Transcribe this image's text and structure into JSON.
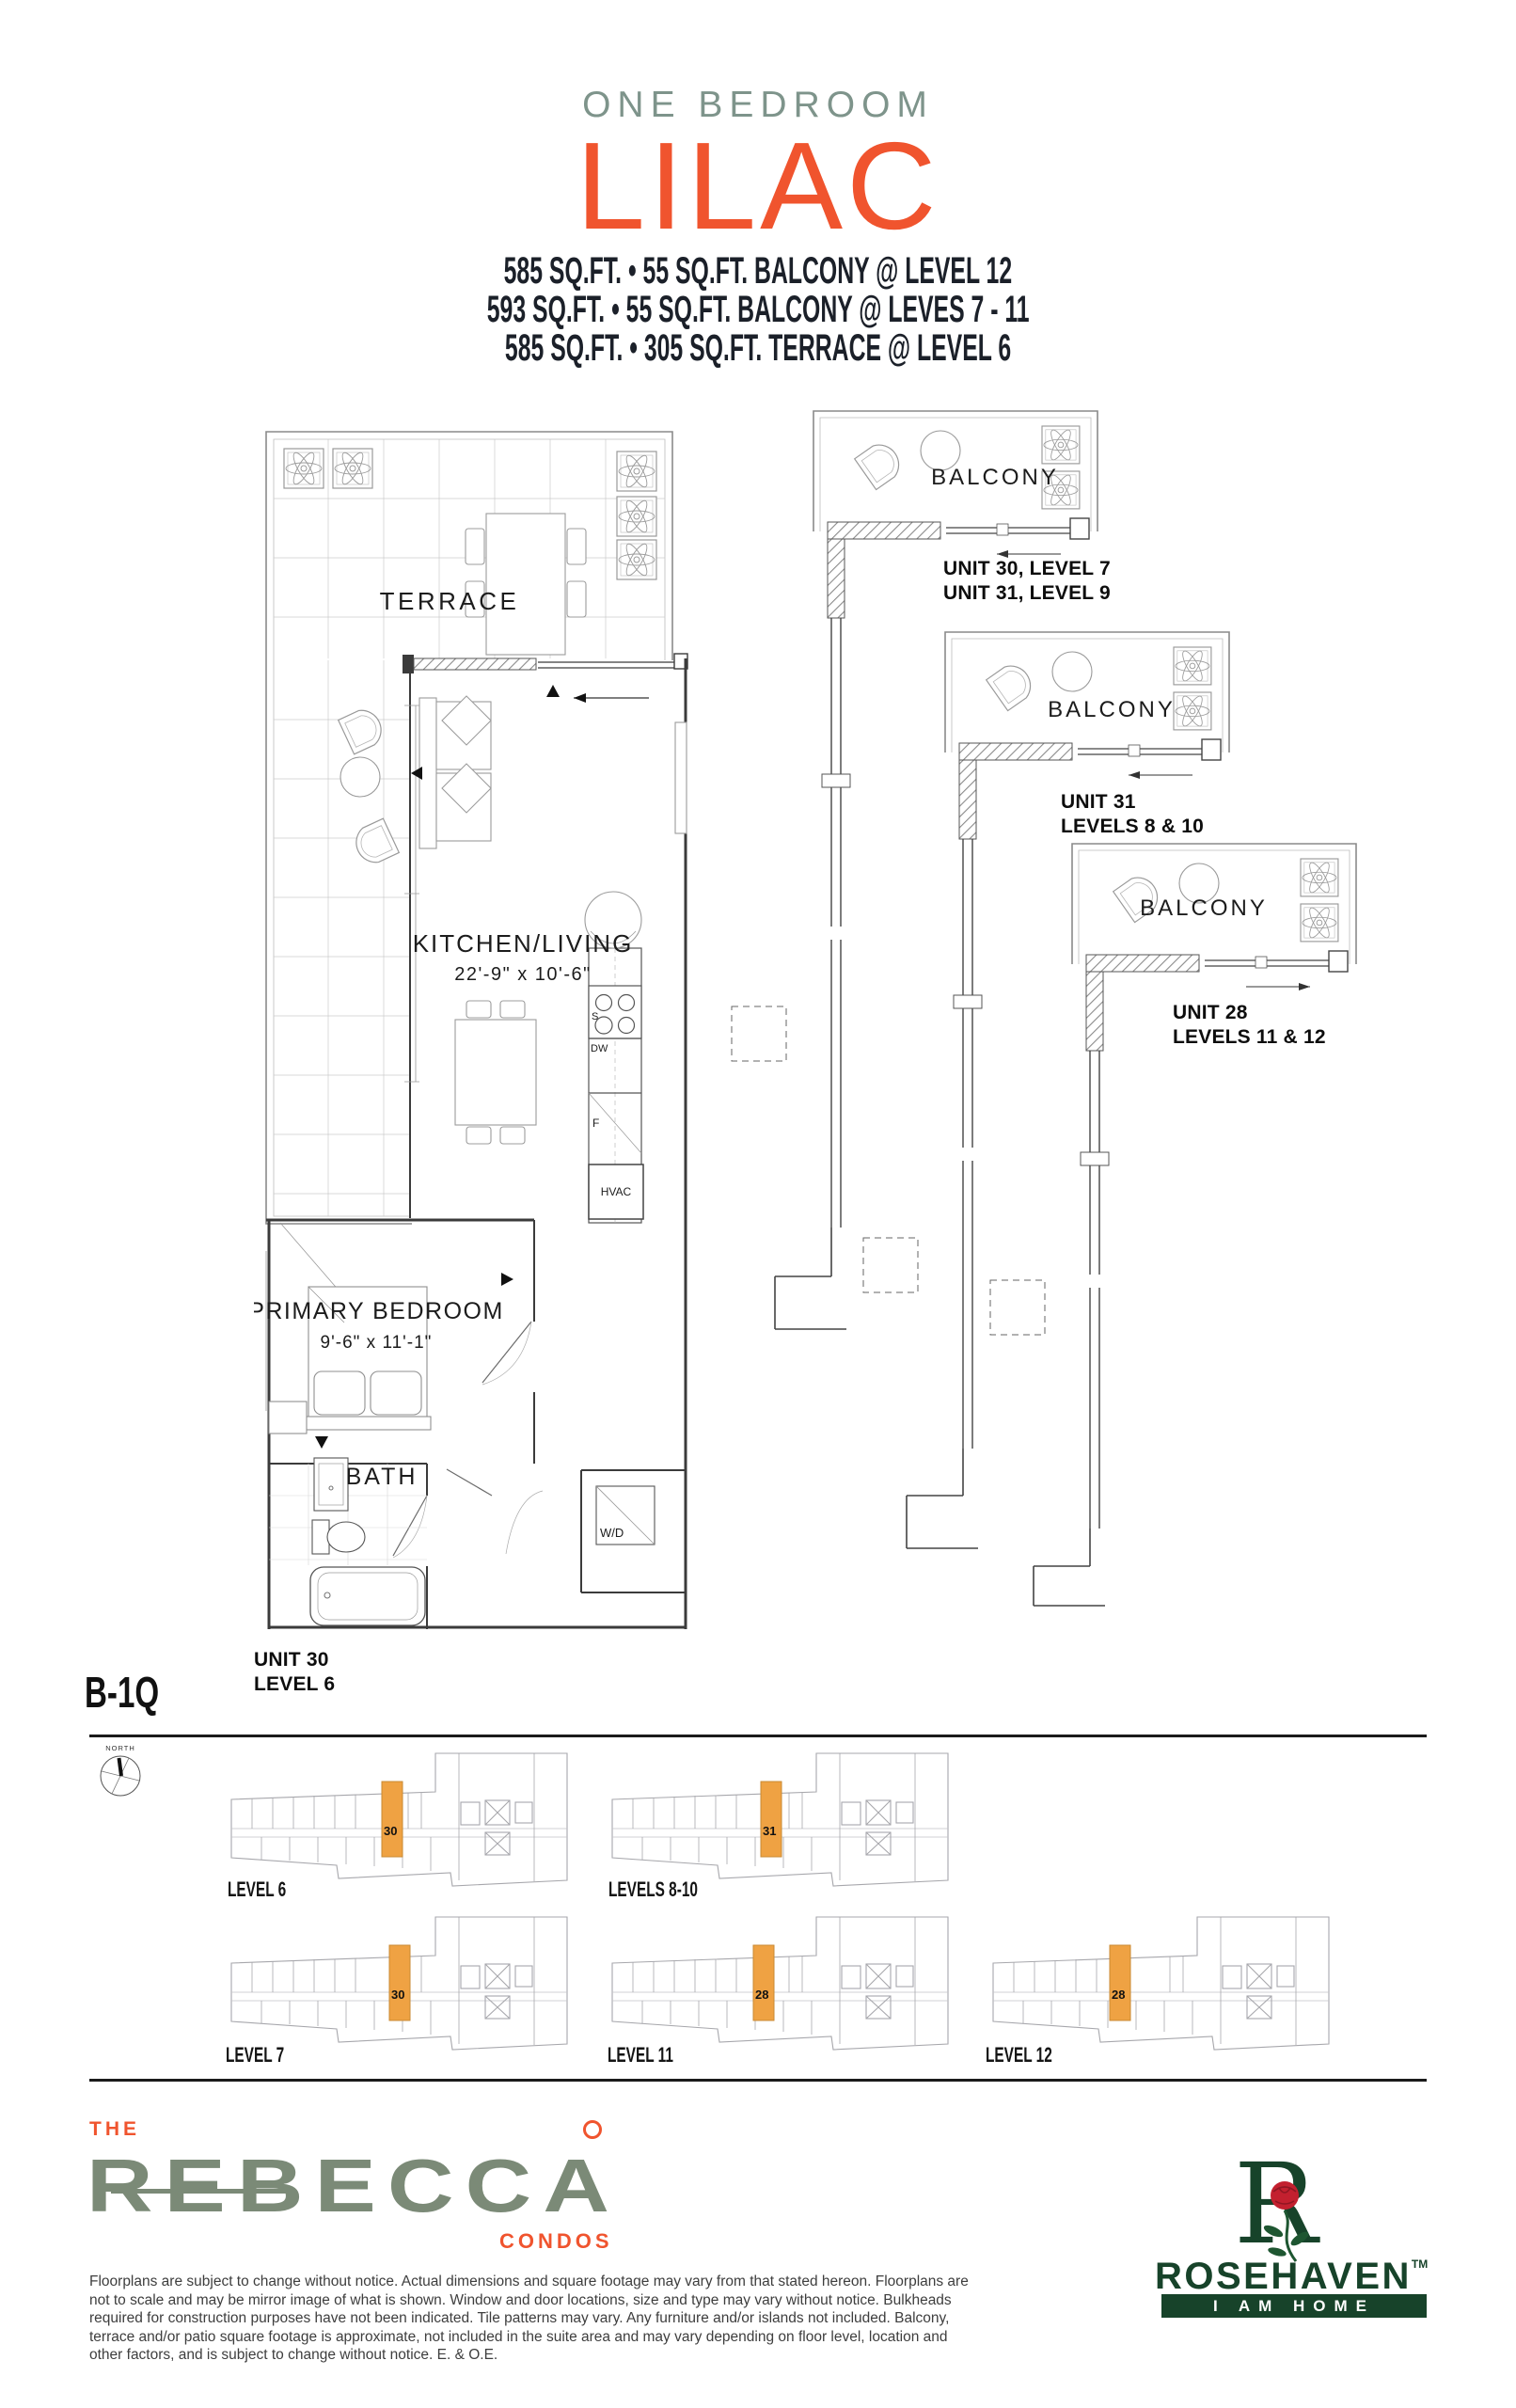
{
  "header": {
    "category": "ONE BEDROOM",
    "plan_name": "LILAC",
    "specs": [
      "585 SQ.FT. • 55 SQ.FT. BALCONY @ LEVEL 12",
      "593 SQ.FT. • 55 SQ.FT. BALCONY @ LEVES 7 - 11",
      "585 SQ.FT. • 305 SQ.FT. TERRACE @ LEVEL 6"
    ]
  },
  "plan": {
    "terrace": "TERRACE",
    "kitchen_living": "KITCHEN/LIVING",
    "kitchen_living_dims": "22'-9\" x 10'-6\"",
    "primary_bedroom": "PRIMARY BEDROOM",
    "primary_bedroom_dims": "9'-6\" x 11'-1\"",
    "bath": "BATH",
    "washer_dryer": "W/D",
    "hvac": "HVAC",
    "fridge": "F",
    "dishwasher": "DW",
    "stove": "S",
    "unit_label_line1": "UNIT 30",
    "unit_label_line2": "LEVEL 6"
  },
  "variants": [
    {
      "balcony": "BALCONY",
      "line1": "UNIT 30, LEVEL 7",
      "line2": "UNIT 31, LEVEL 9"
    },
    {
      "balcony": "BALCONY",
      "line1": "UNIT 31",
      "line2": "LEVELS 8 & 10"
    },
    {
      "balcony": "BALCONY",
      "line1": "UNIT 28",
      "line2": "LEVELS 11 & 12"
    }
  ],
  "plan_code": "B-1Q",
  "compass_label": "NORTH",
  "keyplans": [
    {
      "label": "LEVEL 6",
      "unit": "30"
    },
    {
      "label": "LEVELS 8-10",
      "unit": "31"
    },
    {
      "label": "LEVEL 7",
      "unit": "30"
    },
    {
      "label": "LEVEL 11",
      "unit": "28"
    },
    {
      "label": "LEVEL 12",
      "unit": "28"
    }
  ],
  "footer": {
    "brand_the": "THE",
    "brand_name": "REBECCA",
    "brand_sub": "CONDOS",
    "builder_r": "R",
    "builder_name": "ROSEHAVEN",
    "builder_tm": "TM",
    "builder_tagline": "I AM HOME",
    "disclaimer": "Floorplans are subject to change without notice. Actual dimensions and square footage may vary from that stated hereon. Floorplans are not to scale and may be mirror image of what is shown. Window and door locations, size and type may vary without notice. Bulkheads required for construction purposes have not been indicated. Tile patterns may vary. Any furniture and/or islands not included. Balcony, terrace and/or patio square footage is approximate, not included in the suite area and may vary depending on floor level, location and other factors, and is subject to change without notice. E. & O.E."
  },
  "colors": {
    "accent_orange": "#F0542E",
    "header_sage": "#7E948B",
    "brand_sage": "#7B8A77",
    "rosehaven_green": "#17432A",
    "keyplan_highlight": "#EFA243",
    "ink": "#1B2029"
  }
}
